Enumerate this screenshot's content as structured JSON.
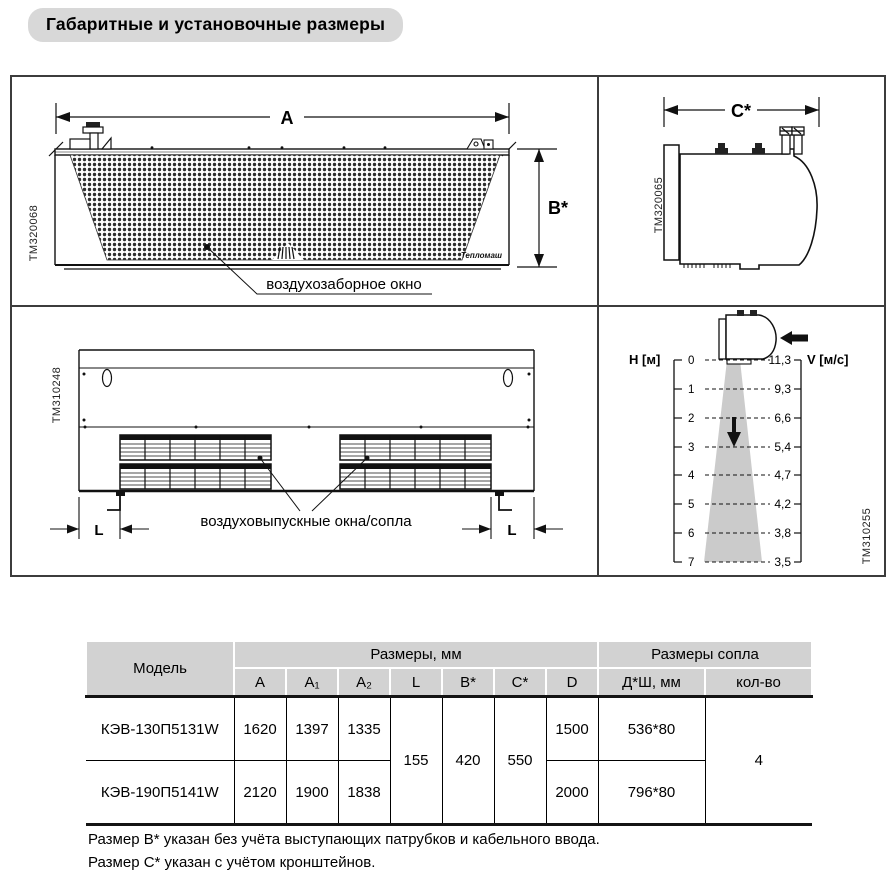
{
  "title": "Габаритные и установочные размеры",
  "drawings": {
    "front_view": {
      "tm": "TM320068",
      "dim_a": "A",
      "dim_b": "B*",
      "brand": "Тепломаш",
      "intake_label": "воздухозаборное окно"
    },
    "side_view": {
      "tm": "TM320065",
      "dim_c": "C*"
    },
    "bottom_view": {
      "tm": "TM310248",
      "dim_l_left": "L",
      "dim_l_right": "L",
      "outlet_label": "воздуховыпускные окна/сопла"
    },
    "flow_diagram": {
      "tm": "TM310255",
      "h_axis": "Н [м]",
      "v_axis": "V [м/с]",
      "levels": [
        {
          "h": "0",
          "v": "11,3"
        },
        {
          "h": "1",
          "v": "9,3"
        },
        {
          "h": "2",
          "v": "6,6"
        },
        {
          "h": "3",
          "v": "5,4"
        },
        {
          "h": "4",
          "v": "4,7"
        },
        {
          "h": "5",
          "v": "4,2"
        },
        {
          "h": "6",
          "v": "3,8"
        },
        {
          "h": "7",
          "v": "3,5"
        }
      ]
    }
  },
  "chart_data": {
    "type": "line",
    "title": "Скорость потока воздушной завесы",
    "xlabel": "Н [м]",
    "ylabel": "V [м/с]",
    "x": [
      0,
      1,
      2,
      3,
      4,
      5,
      6,
      7
    ],
    "values": [
      11.3,
      9.3,
      6.6,
      5.4,
      4.7,
      4.2,
      3.8,
      3.5
    ],
    "legend_position": "none",
    "grid": "dashed-horizontal"
  },
  "table": {
    "header": {
      "model": "Модель",
      "dims_group": "Размеры, мм",
      "nozzle_group": "Размеры сопла",
      "dim_cols": [
        "A",
        "A₁",
        "A₂",
        "L",
        "B*",
        "C*",
        "D"
      ],
      "nozzle_cols": [
        "Д*Ш, мм",
        "кол-во"
      ]
    },
    "rows": [
      {
        "model": "КЭВ-130П5131W",
        "a": "1620",
        "a1": "1397",
        "a2": "1335",
        "d": "1500",
        "nozzle_size": "536*80"
      },
      {
        "model": "КЭВ-190П5141W",
        "a": "2120",
        "a1": "1900",
        "a2": "1838",
        "d": "2000",
        "nozzle_size": "796*80"
      }
    ],
    "merged": {
      "l": "155",
      "b": "420",
      "c": "550",
      "qty": "4"
    }
  },
  "notes": [
    "Размер B* указан без учёта выступающих патрубков и кабельного ввода.",
    "Размер C* указан с учётом кронштейнов."
  ],
  "colors": {
    "header_bg": "#d2d2d2",
    "title_bg": "#d8d8d8",
    "cone_gray": "#cbcbcb",
    "line_black": "#111111",
    "border_gray": "#3c3c3c"
  }
}
